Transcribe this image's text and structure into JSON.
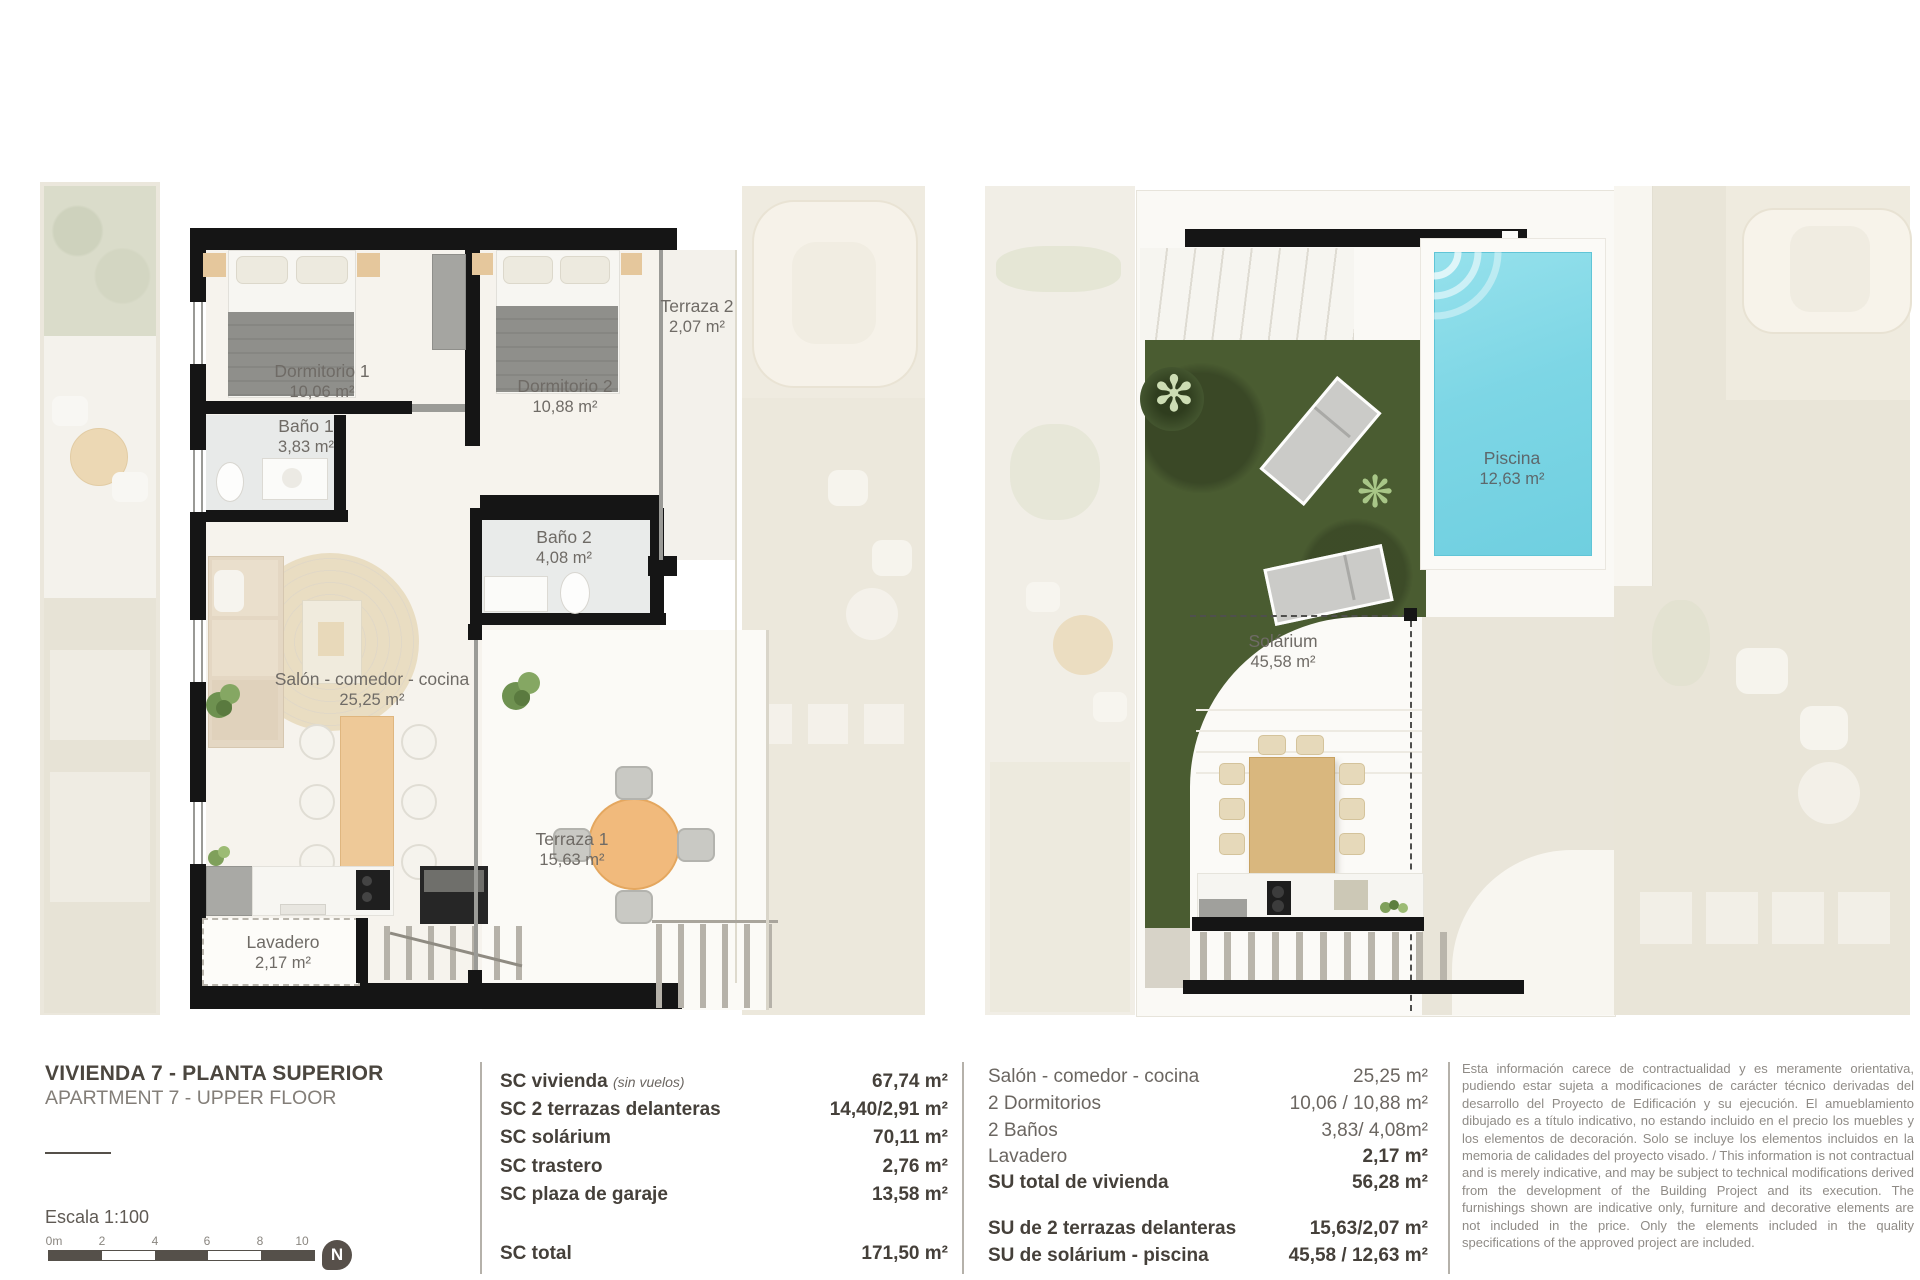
{
  "plans": {
    "left": {
      "rooms": [
        {
          "name": "Dormitorio 1",
          "area": "10,06 m²"
        },
        {
          "name": "Dormitorio 2",
          "area": "10,88 m²"
        },
        {
          "name": "Terraza 2",
          "area": "2,07 m²"
        },
        {
          "name": "Baño 1",
          "area": "3,83 m²"
        },
        {
          "name": "Baño 2",
          "area": "4,08 m²"
        },
        {
          "name": "Salón - comedor - cocina",
          "area": "25,25 m²"
        },
        {
          "name": "Terraza 1",
          "area": "15,63 m²"
        },
        {
          "name": "Lavadero",
          "area": "2,17 m²"
        }
      ]
    },
    "right": {
      "rooms": [
        {
          "name": "Piscina",
          "area": "12,63 m²"
        },
        {
          "name": "Solárium",
          "area": "45,58 m²"
        }
      ]
    }
  },
  "footer": {
    "title": "VIVIENDA 7 - PLANTA SUPERIOR",
    "subtitle": "APARTMENT 7 - UPPER FLOOR",
    "scale_label": "Escala 1:100",
    "scale_ticks": [
      "0m",
      "2",
      "4",
      "6",
      "8",
      "10"
    ],
    "compass_letter": "N",
    "sc": {
      "rows": [
        {
          "label": "SC vivienda",
          "note": "(sin vuelos)",
          "value": "67,74 m²"
        },
        {
          "label": "SC 2 terrazas delanteras",
          "note": "",
          "value": "14,40/2,91 m²"
        },
        {
          "label": "SC solárium",
          "note": "",
          "value": "70,11 m²"
        },
        {
          "label": "SC trastero",
          "note": "",
          "value": "2,76 m²"
        },
        {
          "label": "SC plaza de garaje",
          "note": "",
          "value": "13,58 m²"
        }
      ],
      "total_label": "SC total",
      "total_value": "171,50 m²"
    },
    "su": {
      "rows": [
        {
          "label": "Salón - comedor - cocina",
          "value": "25,25 m²"
        },
        {
          "label": "2 Dormitorios",
          "value": "10,06 / 10,88 m²"
        },
        {
          "label": "2 Baños",
          "value": "3,83/ 4,08m²"
        },
        {
          "label": "Lavadero",
          "value": "2,17 m²"
        },
        {
          "label": "SU total de vivienda",
          "value": "56,28 m²"
        }
      ],
      "extras": [
        {
          "label": "SU de 2 terrazas delanteras",
          "value": "15,63/2,07 m²"
        },
        {
          "label": "SU de solárium - piscina",
          "value": "45,58 / 12,63 m²"
        }
      ]
    },
    "disclaimer": "Esta información carece de contractualidad y es meramente orientativa, pudiendo estar sujeta a modificaciones de carácter técnico derivadas del desarrollo del Proyecto de Edificación y su ejecución. El amueblamiento dibujado es a título indicativo, no estando incluido en el precio los muebles y los elementos de decoración. Solo se incluye los elementos incluidos en la memoria de calidades del proyecto visado. / This information is not contractual and is merely indicative, and may be subject to technical modifications derived from the development of the Building Project and its execution. The furnishings shown are indicative only, furniture and decorative elements are not included in the price. Only the elements included in the quality specifications of the approved project are included."
  },
  "colors": {
    "wall": "#151515",
    "pool_water": "#7dd6e5",
    "lawn_green": "#4a5c31",
    "wood_tan": "#eec998",
    "context_fade": "#ece8dc",
    "label_text": "#6f6b66"
  }
}
